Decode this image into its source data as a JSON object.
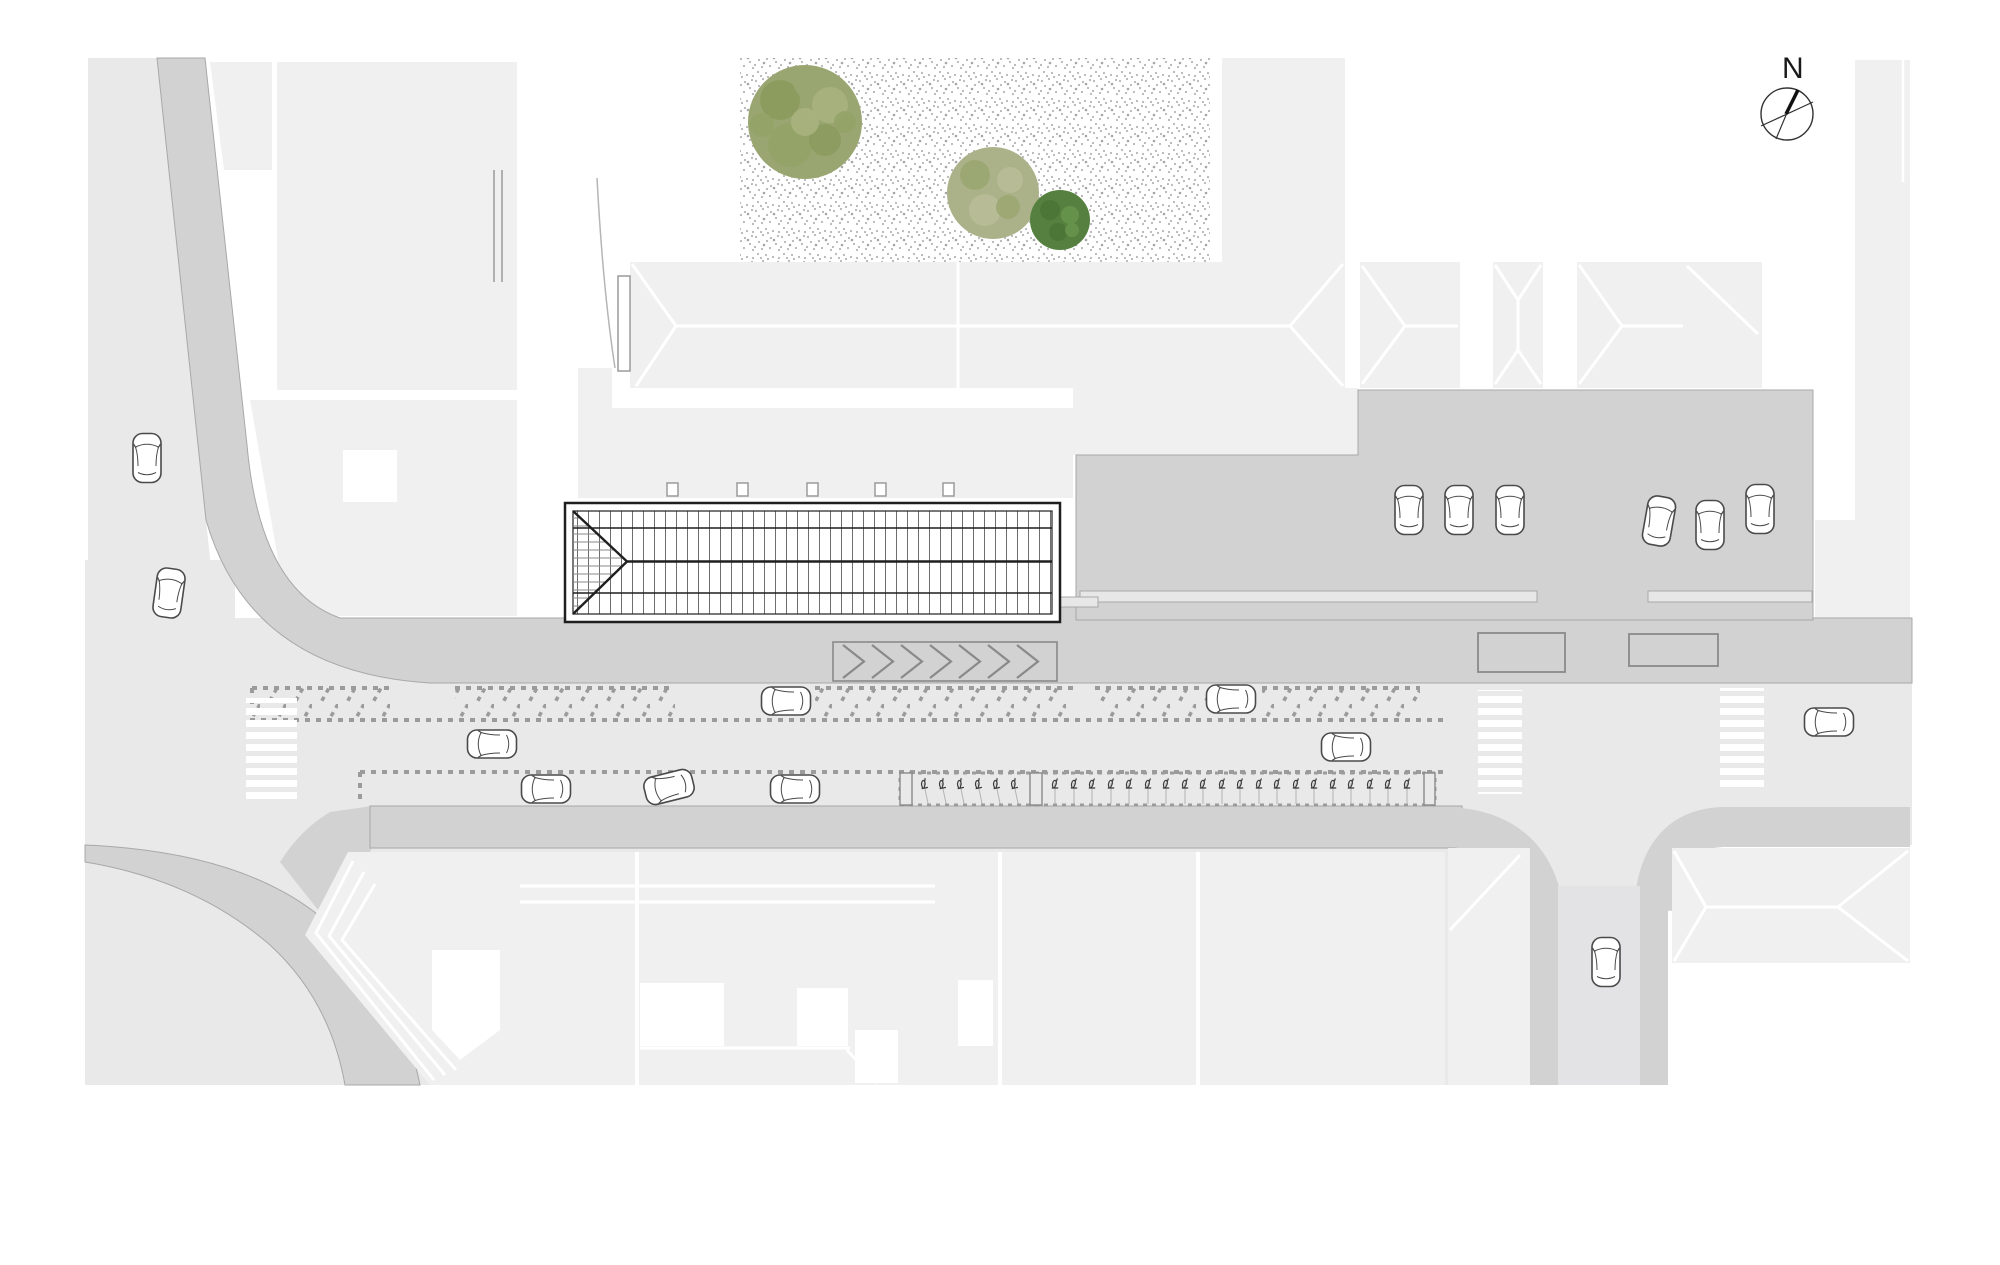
{
  "title": "Site plan – street with market hall, parking and plaza",
  "compass": {
    "label": "N"
  },
  "colors": {
    "bg": "#ffffff",
    "ground": "#e9e9ea",
    "building": "#f0f0f1",
    "road": "#d2d2d3",
    "street": "#e3e3e5",
    "curb": "#e7e7e8",
    "marking": "#9b9b9b",
    "hatch": "#8a8a8a",
    "hall-line": "#1f1f1f",
    "car-stroke": "#4a4a4a",
    "stipple": "#b5b5b5",
    "tree-olive": "#9aa671",
    "tree-olive-light": "#abb289",
    "tree-dark": "#55803f"
  },
  "inventory": {
    "trees": 3,
    "cars_total": 17,
    "cars_in_parking_lot": 6,
    "cars_on_street": 8,
    "cars_on_left_road": 2,
    "cars_on_south_street": 1,
    "zebra_crossings": 3,
    "chevron_marks": 7,
    "bike_stands": 26,
    "hall_columns": 5,
    "echelon_parking_bays": 5
  }
}
